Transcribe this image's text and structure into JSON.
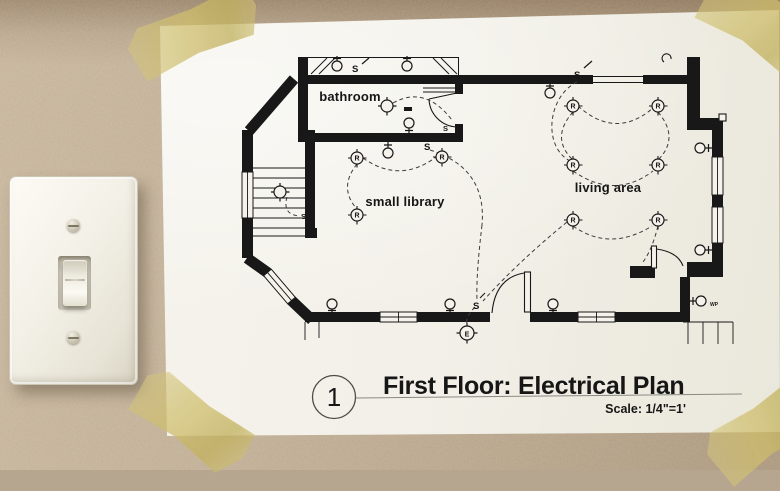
{
  "drawing": {
    "title": "First Floor: Electrical Plan",
    "sheet_number": "1",
    "scale_label": "Scale: 1/4\"=1'",
    "rooms": [
      {
        "name": "bathroom"
      },
      {
        "name": "small library"
      },
      {
        "name": "living area"
      }
    ],
    "legend": {
      "recessed_light": "R",
      "switch": "S",
      "exterior_light": "E",
      "weatherproof": "WP"
    }
  },
  "colors": {
    "wall": "#b7a68f",
    "paper": "#f2f0e8",
    "ink": "#181818",
    "tape": "#d5c570"
  }
}
